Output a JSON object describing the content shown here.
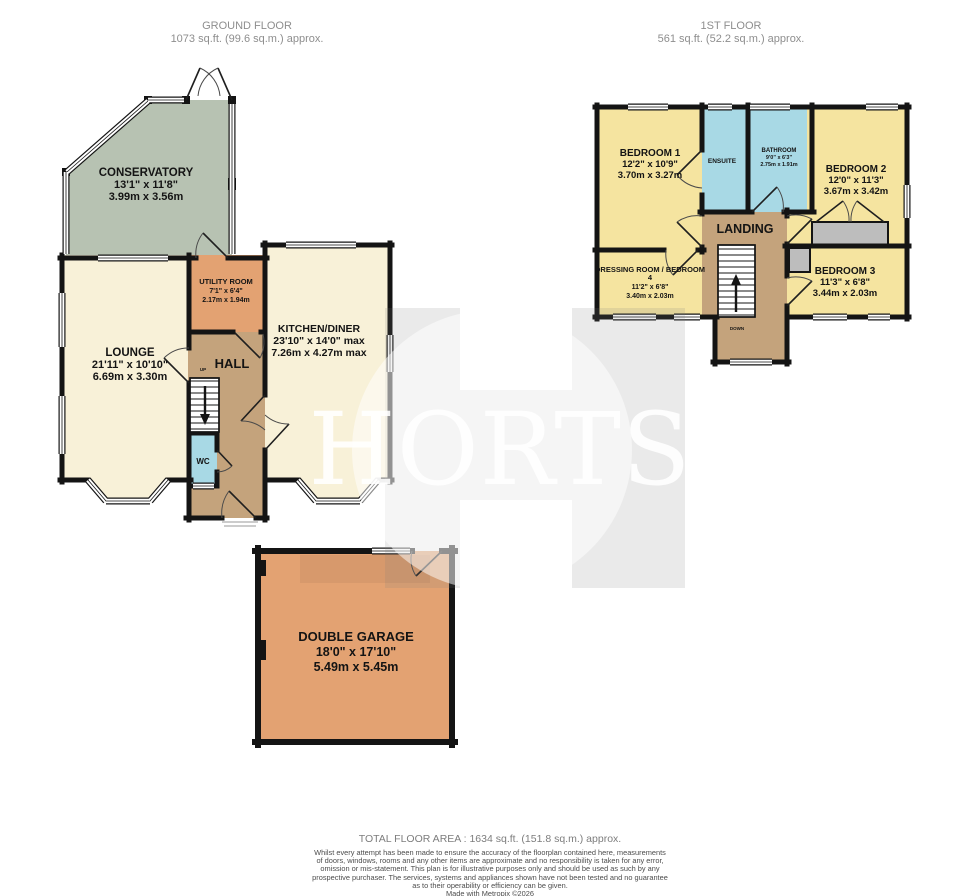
{
  "headers": {
    "ground": {
      "title": "GROUND FLOOR",
      "area": "1073 sq.ft. (99.6 sq.m.) approx."
    },
    "first": {
      "title": "1ST FLOOR",
      "area": "561 sq.ft. (52.2 sq.m.) approx."
    }
  },
  "watermark": {
    "text": "HORTS"
  },
  "rooms": {
    "conservatory": {
      "name": "CONSERVATORY",
      "imperial": "13'1\" x 11'8\"",
      "metric": "3.99m x 3.56m"
    },
    "lounge": {
      "name": "LOUNGE",
      "imperial": "21'11\" x 10'10\"",
      "metric": "6.69m x 3.30m"
    },
    "utility": {
      "name": "UTILITY ROOM",
      "imperial": "7'1\" x 6'4\"",
      "metric": "2.17m x 1.94m"
    },
    "kitchen": {
      "name": "KITCHEN/DINER",
      "imperial": "23'10\" x 14'0\" max",
      "metric": "7.26m x 4.27m max"
    },
    "hall": {
      "name": "HALL",
      "up": "UP"
    },
    "wc": {
      "name": "WC"
    },
    "bedroom1": {
      "name": "BEDROOM 1",
      "imperial": "12'2\" x 10'9\"",
      "metric": "3.70m x 3.27m"
    },
    "ensuite": {
      "name": "ENSUITE"
    },
    "bathroom": {
      "name": "BATHROOM",
      "imperial": "9'0\" x 6'3\"",
      "metric": "2.75m x 1.91m"
    },
    "bedroom2": {
      "name": "BEDROOM 2",
      "imperial": "12'0\" x 11'3\"",
      "metric": "3.67m x 3.42m"
    },
    "landing": {
      "name": "LANDING",
      "down": "DOWN"
    },
    "dressing": {
      "line1": "DRESSING ROOM / BEDROOM",
      "line2": "4",
      "imperial": "11'2\" x 6'8\"",
      "metric": "3.40m x 2.03m"
    },
    "bedroom3": {
      "name": "BEDROOM 3",
      "imperial": "11'3\" x 6'8\"",
      "metric": "3.44m x 2.03m"
    },
    "garage": {
      "name": "DOUBLE GARAGE",
      "imperial": "18'0\" x 17'10\"",
      "metric": "5.49m x 5.45m"
    }
  },
  "footer": {
    "total": "TOTAL FLOOR AREA : 1634 sq.ft. (151.8 sq.m.) approx.",
    "lines": [
      "Whilst every attempt has been made to ensure the accuracy of the floorplan contained here, measurements",
      "of doors, windows, rooms and any other items are approximate and no responsibility is taken for any error,",
      "omission or mis-statement. This plan is for illustrative purposes only and should be used as such by any",
      "prospective purchaser. The services, systems and appliances shown have not been tested and no guarantee",
      "as to their operability or efficiency can be given."
    ],
    "credit": "Made with Metropix ©2026"
  }
}
